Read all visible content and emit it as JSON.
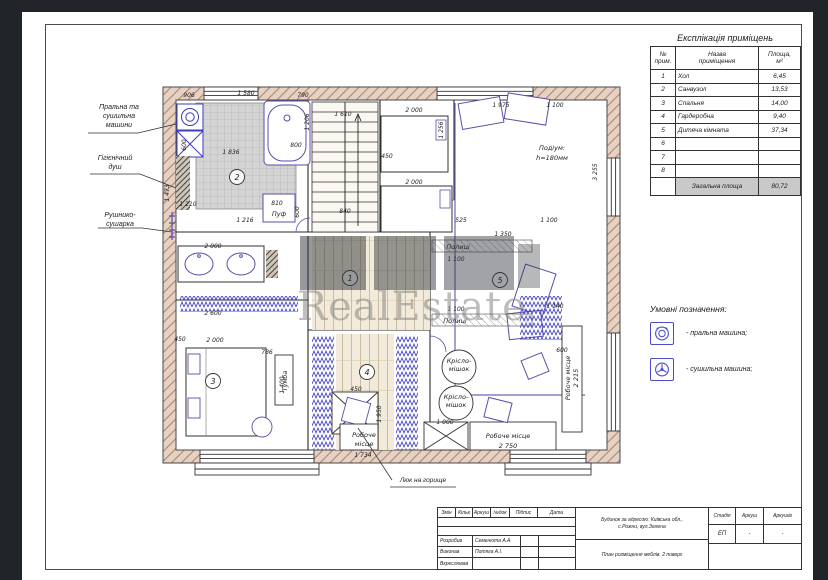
{
  "watermark": {
    "text": "RealEstate"
  },
  "colors": {
    "wall_fill": "#e6d2c3",
    "wall_hatch_line": "#ad8574",
    "furniture_accent": "#5b4ea8",
    "appliance_accent": "#3b3bc0",
    "legend_accent": "#4a4ace",
    "total_row_bg": "#c9c9c9"
  },
  "explication": {
    "title": "Експлікація приміщень",
    "headers": {
      "no": "№\nприм.",
      "name": "Назва\nприміщення",
      "area": "Площа,\nм²"
    },
    "rows": [
      {
        "no": "1",
        "name": "Хол",
        "area": "6,45"
      },
      {
        "no": "2",
        "name": "Санвузол",
        "area": "13,53"
      },
      {
        "no": "3",
        "name": "Спальня",
        "area": "14,00"
      },
      {
        "no": "4",
        "name": "Гардеробна",
        "area": "9,40"
      },
      {
        "no": "5",
        "name": "Дитяча кімната",
        "area": "37,34"
      },
      {
        "no": "6",
        "name": "",
        "area": ""
      },
      {
        "no": "7",
        "name": "",
        "area": ""
      },
      {
        "no": "8",
        "name": "",
        "area": ""
      }
    ],
    "total_label": "Загальна площа",
    "total_value": "80,72"
  },
  "legend": {
    "title": "Умовні позначення:",
    "items": [
      {
        "icon": "washing-machine-icon",
        "label": "- пральна машина;"
      },
      {
        "icon": "drying-machine-icon",
        "label": "- сушильна машина;"
      }
    ]
  },
  "plan": {
    "labels": {
      "washer_dryer": "Пральна та\nсушильна\nмашини",
      "shower": "Гігієнічний\nдуш",
      "towel": "Рушнико-\nсушарка",
      "attic": "Люк на горище"
    },
    "rooms": [
      {
        "n": "1",
        "x": 350,
        "y": 278
      },
      {
        "n": "2",
        "x": 237,
        "y": 177
      },
      {
        "n": "3",
        "x": 213,
        "y": 381
      },
      {
        "n": "4",
        "x": 367,
        "y": 372
      },
      {
        "n": "5",
        "x": 500,
        "y": 280
      }
    ],
    "annotations": [
      {
        "t": "Пуф",
        "x": 279,
        "y": 216
      },
      {
        "t": "Подіум:",
        "x": 552,
        "y": 150
      },
      {
        "t": "h=180мм",
        "x": 552,
        "y": 160
      },
      {
        "t": "Полиці",
        "x": 458,
        "y": 249
      },
      {
        "t": "Полиці",
        "x": 455,
        "y": 323
      },
      {
        "t": "Крісло-",
        "x": 459,
        "y": 363
      },
      {
        "t": "мішок",
        "x": 459,
        "y": 371
      },
      {
        "t": "Крісло-",
        "x": 456,
        "y": 399
      },
      {
        "t": "мішок",
        "x": 456,
        "y": 407
      },
      {
        "t": "Робоче",
        "x": 364,
        "y": 437
      },
      {
        "t": "місце",
        "x": 364,
        "y": 446
      },
      {
        "t": "Робоче місце",
        "x": 508,
        "y": 438
      },
      {
        "t": "2 750",
        "x": 508,
        "y": 448
      },
      {
        "t": "Робоче місце",
        "x": 570,
        "y": 378,
        "r": -90
      },
      {
        "t": "2 215",
        "x": 578,
        "y": 378,
        "r": -90
      },
      {
        "t": "Тумба",
        "x": 287,
        "y": 381,
        "r": -90
      }
    ],
    "dimensions": [
      {
        "t": "906",
        "x": 189,
        "y": 97
      },
      {
        "t": "1 580",
        "x": 246,
        "y": 95
      },
      {
        "t": "790",
        "x": 303,
        "y": 97
      },
      {
        "t": "1 610",
        "x": 343,
        "y": 116
      },
      {
        "t": "450",
        "x": 387,
        "y": 158
      },
      {
        "t": "2 000",
        "x": 414,
        "y": 112
      },
      {
        "t": "1 975",
        "x": 501,
        "y": 107
      },
      {
        "t": "1 100",
        "x": 555,
        "y": 107
      },
      {
        "t": "1 836",
        "x": 231,
        "y": 154
      },
      {
        "t": "800",
        "x": 296,
        "y": 147
      },
      {
        "t": "600",
        "x": 186,
        "y": 145,
        "r": -90
      },
      {
        "t": "1 216",
        "x": 245,
        "y": 222
      },
      {
        "t": "1 210",
        "x": 188,
        "y": 206
      },
      {
        "t": "810",
        "x": 277,
        "y": 205
      },
      {
        "t": "840",
        "x": 345,
        "y": 213
      },
      {
        "t": "600",
        "x": 299,
        "y": 212,
        "r": -90
      },
      {
        "t": "2 000",
        "x": 213,
        "y": 248
      },
      {
        "t": "1 473",
        "x": 169,
        "y": 193,
        "r": -90
      },
      {
        "t": "2 000",
        "x": 414,
        "y": 184
      },
      {
        "t": "1 256",
        "x": 443,
        "y": 130,
        "r": -90
      },
      {
        "t": "1 206",
        "x": 309,
        "y": 122,
        "r": -90
      },
      {
        "t": "525",
        "x": 461,
        "y": 222
      },
      {
        "t": "1 350",
        "x": 503,
        "y": 236
      },
      {
        "t": "1 100",
        "x": 456,
        "y": 261
      },
      {
        "t": "1 100",
        "x": 456,
        "y": 311
      },
      {
        "t": "1 100",
        "x": 549,
        "y": 222
      },
      {
        "t": "2 600",
        "x": 213,
        "y": 315
      },
      {
        "t": "450",
        "x": 180,
        "y": 341
      },
      {
        "t": "2 000",
        "x": 215,
        "y": 342
      },
      {
        "t": "786",
        "x": 267,
        "y": 354
      },
      {
        "t": "1 400",
        "x": 284,
        "y": 385,
        "r": -90
      },
      {
        "t": "450",
        "x": 356,
        "y": 391
      },
      {
        "t": "1 950",
        "x": 381,
        "y": 414,
        "r": -90
      },
      {
        "t": "1 734",
        "x": 363,
        "y": 457
      },
      {
        "t": "1 000",
        "x": 445,
        "y": 424
      },
      {
        "t": "600",
        "x": 562,
        "y": 352
      },
      {
        "t": "1 140",
        "x": 555,
        "y": 308
      },
      {
        "t": "3 255",
        "x": 597,
        "y": 172,
        "r": -90
      }
    ]
  },
  "title_block": {
    "object": "Будинок за адресою: Київська обл.,\nс.Рожни, вул.Зелена",
    "drawing_title": "План розміщення меблів. 2 поверх",
    "columns": [
      "Змін",
      "Кільк",
      "Аркуш",
      "№док",
      "Підпис",
      "Дата"
    ],
    "roles": [
      {
        "role": "Розробив",
        "name": "Семенюта А.А."
      },
      {
        "role": "Виконав",
        "name": "Потяга А.І."
      },
      {
        "role": "Вкреслював",
        "name": ""
      }
    ],
    "stage": {
      "header": "Стадія",
      "value": "ЕП"
    },
    "sheet": {
      "header": "Аркуш",
      "value": "-"
    },
    "sheets": {
      "header": "Аркушів",
      "value": "-"
    }
  }
}
